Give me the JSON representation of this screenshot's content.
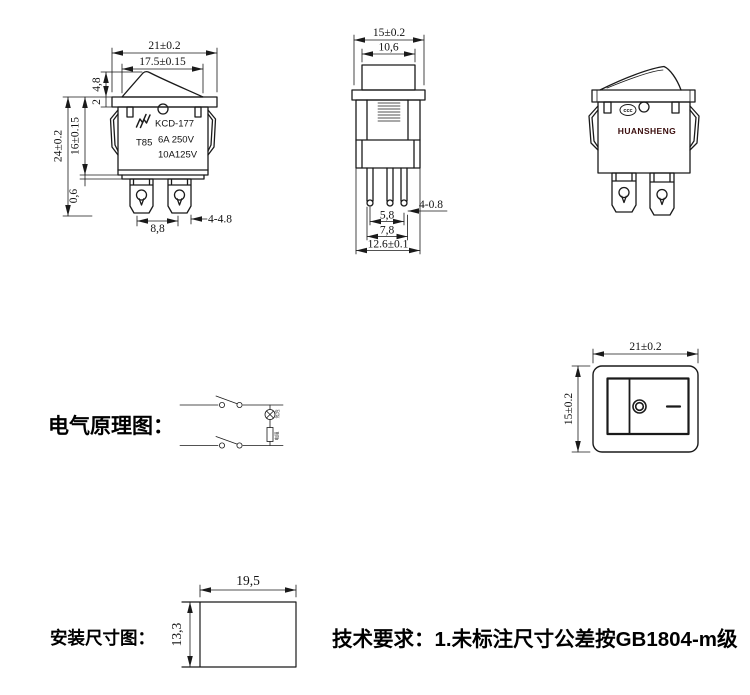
{
  "front_view": {
    "dim_width": "21±0.2",
    "dim_rocker_width": "17.5±0.15",
    "dim_rocker_height": "4,8",
    "dim_flange_thickness": "2",
    "dim_total_height": "24±0.2",
    "dim_body_height": "16±0.15",
    "dim_step": "0,6",
    "dim_pin_spacing": "8,8",
    "dim_pin_size": "4-4.8",
    "model": "KCD-177",
    "t_rating": "T85",
    "rating_line1": "6A 250V",
    "rating_line2": "10A125V"
  },
  "side_view": {
    "dim_width": "15±0.2",
    "dim_button_width": "10,6",
    "dim_pin_thickness": "4-0.8",
    "dim_pin_pitch_inner": "5,8",
    "dim_pin_pitch_outer": "7,8",
    "dim_pin_span": "12.6±0.1"
  },
  "perspective_view": {
    "brand": "HUANSHENG",
    "cert_mark": "ccc"
  },
  "schematic": {
    "label": "电气原理图：",
    "lamp_label": "氖泡",
    "resistor_label": "电阻"
  },
  "panel_view": {
    "dim_width": "21±0.2",
    "dim_height": "15±0.2"
  },
  "install_view": {
    "label": "安装尺寸图：",
    "dim_width": "19,5",
    "dim_height": "13,3"
  },
  "notes": {
    "tech_requirements": "技术要求：1.未标注尺寸公差按GB1804-m级"
  },
  "colors": {
    "line": "#1a1a1a",
    "brand_text": "#3a0d0d"
  }
}
